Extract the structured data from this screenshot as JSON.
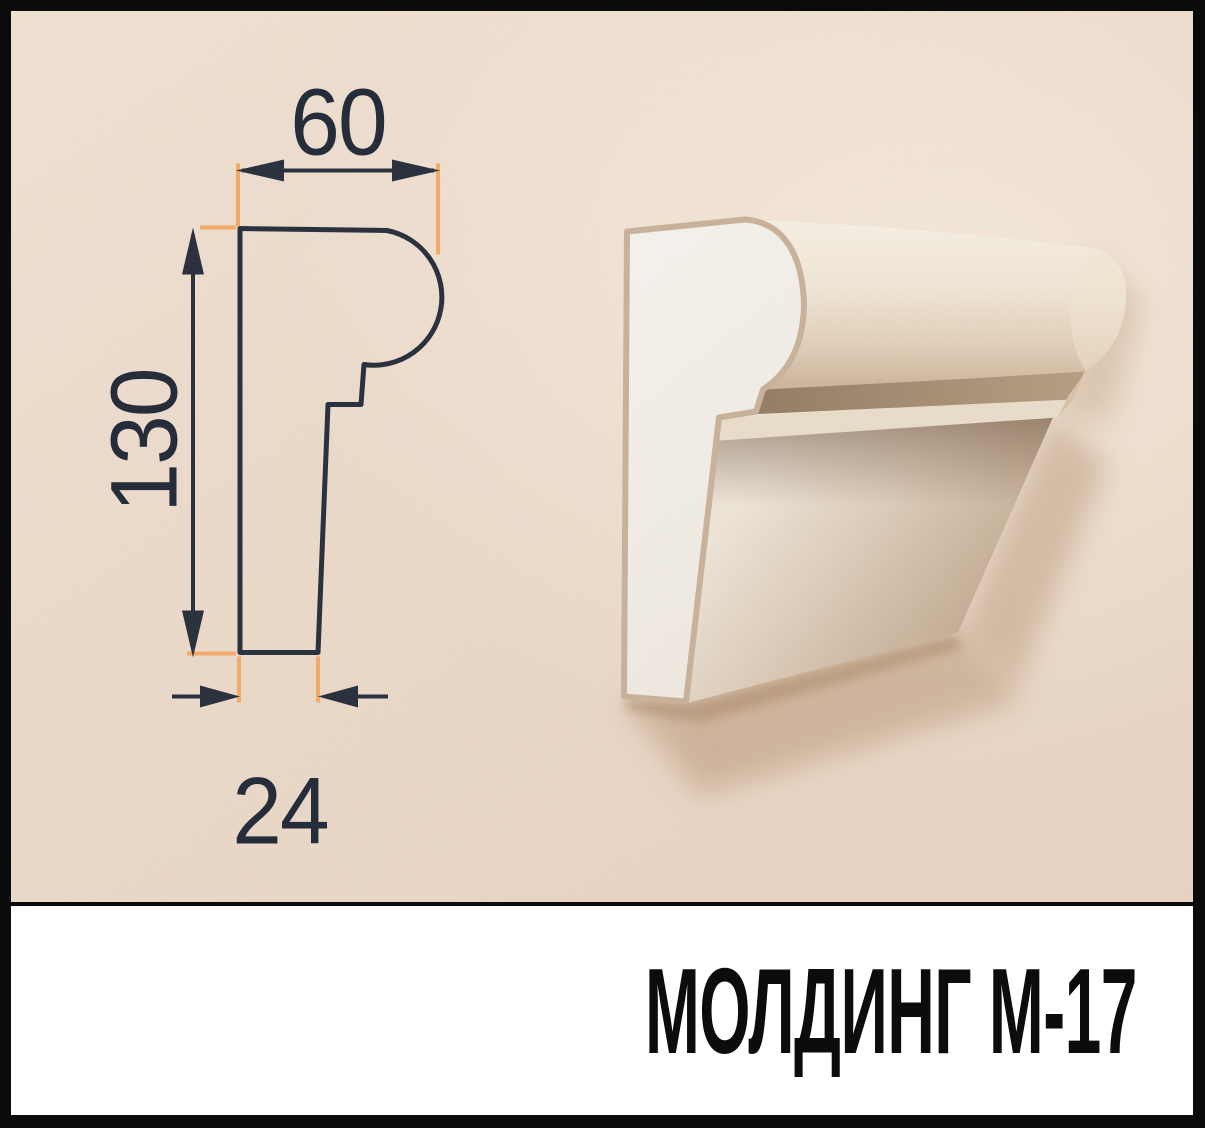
{
  "banner": {
    "title": "МОЛДИНГ М-17"
  },
  "diagram": {
    "width_mm": "60",
    "height_mm": "130",
    "thickness_mm": "24"
  },
  "colors": {
    "frame_border": "#0b0b0b",
    "wall_beige": "#ebd9c9",
    "drawing_line": "#262d3a",
    "extension_accent_orange": "#f3a965",
    "banner_background": "#ffffff",
    "banner_text": "#0c0c0c",
    "molding_face_white": "#f4f0ea",
    "molding_cut_edge_tan": "#c9b199",
    "wall_shadow": "#b99878"
  }
}
